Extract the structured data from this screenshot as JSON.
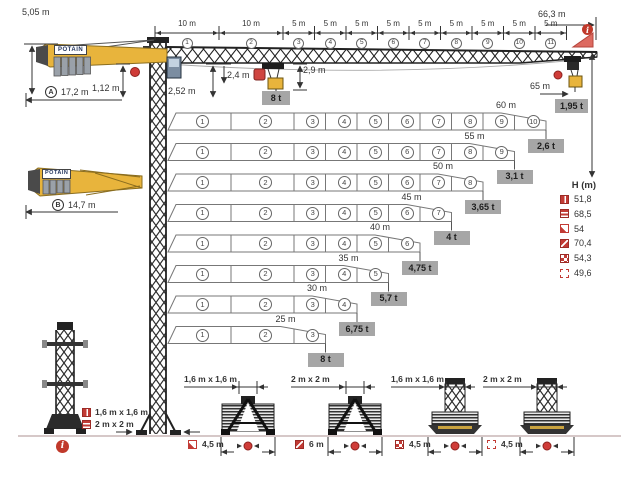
{
  "brand": "POTAIN",
  "colors": {
    "crane_yellow": "#E8B43C",
    "accent_red": "#C23B35",
    "load_box_gray": "#A6A6A6",
    "lattice_dark": "#2B2B2B"
  },
  "top": {
    "overall_length": "66,3 m",
    "counterjib_height": "5,05 m",
    "radius_a": {
      "label": "A",
      "value": "17,2 m"
    },
    "dim_112": "1,12 m",
    "dim_252": "2,52 m",
    "dim_24": "2,4 m",
    "dim_29": "2,9 m",
    "max_load": "8 t",
    "tip_radius": "65 m",
    "tip_load": "1,95 t",
    "jib_sections": [
      {
        "num": "1",
        "len": "10 m"
      },
      {
        "num": "2",
        "len": "10 m"
      },
      {
        "num": "3",
        "len": "5 m"
      },
      {
        "num": "4",
        "len": "5 m"
      },
      {
        "num": "5",
        "len": "5 m"
      },
      {
        "num": "6",
        "len": "5 m"
      },
      {
        "num": "7",
        "len": "5 m"
      },
      {
        "num": "8",
        "len": "5 m"
      },
      {
        "num": "9",
        "len": "5 m"
      },
      {
        "num": "10",
        "len": "5 m"
      },
      {
        "num": "11",
        "len": "5 m"
      }
    ]
  },
  "counterjib_b": {
    "label": "B",
    "value": "14,7 m"
  },
  "jib_configs": [
    {
      "length": "60 m",
      "sections": 10,
      "tip_load": "2,6 t"
    },
    {
      "length": "55 m",
      "sections": 9,
      "tip_load": "3,1 t"
    },
    {
      "length": "50 m",
      "sections": 8,
      "tip_load": "3,65 t"
    },
    {
      "length": "45 m",
      "sections": 7,
      "tip_load": "4 t"
    },
    {
      "length": "40 m",
      "sections": 6,
      "tip_load": "4,75 t"
    },
    {
      "length": "35 m",
      "sections": 5,
      "tip_load": "5,7 t"
    },
    {
      "length": "30 m",
      "sections": 4,
      "tip_load": "6,75 t"
    },
    {
      "length": "25 m",
      "sections": 3,
      "tip_load": "8 t"
    }
  ],
  "height_table": {
    "header": "H (m)",
    "rows": [
      {
        "icon": "mast-1-6-icon",
        "value": "51,8"
      },
      {
        "icon": "mast-2-icon",
        "value": "68,5"
      },
      {
        "icon": "base-corner-icon",
        "value": "54"
      },
      {
        "icon": "base-diagonal-icon",
        "value": "70,4"
      },
      {
        "icon": "base-checker-icon",
        "value": "54,3"
      },
      {
        "icon": "base-dashed-icon",
        "value": "49,6"
      }
    ]
  },
  "mast_legend": [
    {
      "icon": "mast-1-6-icon",
      "label": "1,6 m x 1,6 m"
    },
    {
      "icon": "mast-2-icon",
      "label": "2 m x 2 m"
    }
  ],
  "bases": [
    {
      "label": "1,6 m x 1,6 m",
      "icon": "base-corner-icon",
      "track": "4,5 m"
    },
    {
      "label": "2 m x 2 m",
      "icon": "base-diagonal-icon",
      "track": "6 m"
    },
    {
      "label": "1,6 m x 1,6 m",
      "icon": "base-checker-icon",
      "track": "4,5 m"
    },
    {
      "label": "2 m x 2 m",
      "icon": "base-dashed-icon",
      "track": "4,5 m"
    }
  ],
  "info_symbol": "i"
}
